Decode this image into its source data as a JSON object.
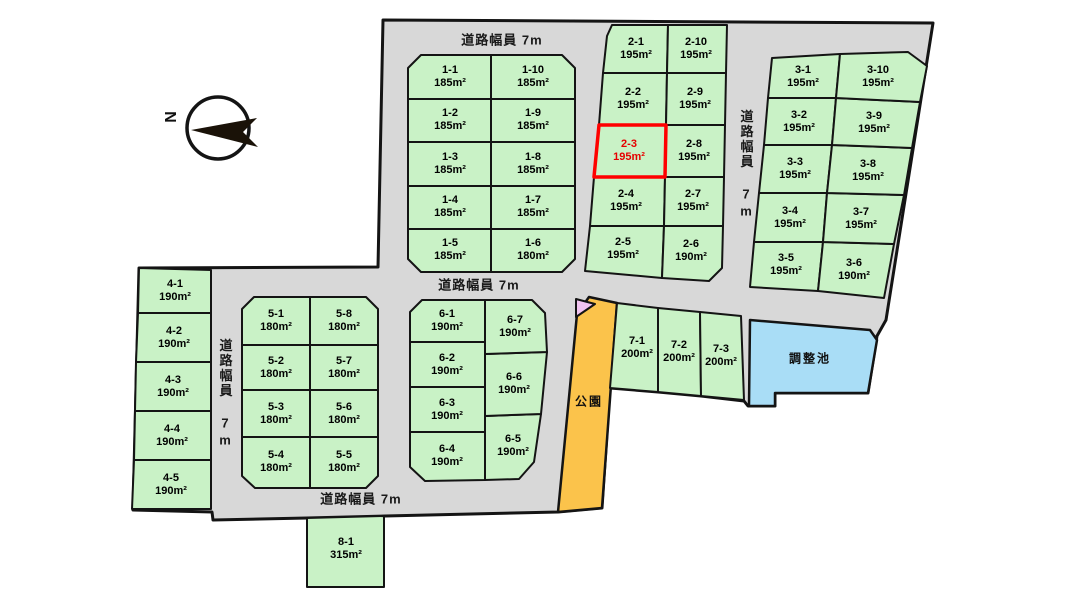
{
  "map_title": "宅地分譲区画図",
  "compass": {
    "north_label": "N"
  },
  "road_labels": {
    "top": "道路幅員 7m",
    "middle": "道路幅員 7m",
    "bottom": "道路幅員 7m",
    "left_vertical": "道路幅員 7m",
    "right_vertical": "道路幅員 7m"
  },
  "features": {
    "park_label": "公園",
    "pond_label": "調整池"
  },
  "highlighted_lot": "2-3",
  "colors": {
    "lot_fill": "#c9f2c6",
    "road_fill": "#d8d8d8",
    "park_fill": "#fbc34b",
    "pond_fill": "#a9ddf6",
    "pink_marker": "#f2c4f0",
    "outline": "#141414",
    "highlight_red": "#ff0000",
    "highlight_text": "#e60000"
  },
  "blocks": [
    {
      "name": "block-1",
      "lots": [
        {
          "id": "1-1",
          "area": "185m²"
        },
        {
          "id": "1-2",
          "area": "185m²"
        },
        {
          "id": "1-3",
          "area": "185m²"
        },
        {
          "id": "1-4",
          "area": "185m²"
        },
        {
          "id": "1-5",
          "area": "185m²"
        },
        {
          "id": "1-6",
          "area": "180m²"
        },
        {
          "id": "1-7",
          "area": "185m²"
        },
        {
          "id": "1-8",
          "area": "185m²"
        },
        {
          "id": "1-9",
          "area": "185m²"
        },
        {
          "id": "1-10",
          "area": "185m²"
        }
      ]
    },
    {
      "name": "block-2",
      "lots": [
        {
          "id": "2-1",
          "area": "195m²"
        },
        {
          "id": "2-2",
          "area": "195m²"
        },
        {
          "id": "2-3",
          "area": "195m²"
        },
        {
          "id": "2-4",
          "area": "195m²"
        },
        {
          "id": "2-5",
          "area": "195m²"
        },
        {
          "id": "2-6",
          "area": "190m²"
        },
        {
          "id": "2-7",
          "area": "195m²"
        },
        {
          "id": "2-8",
          "area": "195m²"
        },
        {
          "id": "2-9",
          "area": "195m²"
        },
        {
          "id": "2-10",
          "area": "195m²"
        }
      ]
    },
    {
      "name": "block-3",
      "lots": [
        {
          "id": "3-1",
          "area": "195m²"
        },
        {
          "id": "3-2",
          "area": "195m²"
        },
        {
          "id": "3-3",
          "area": "195m²"
        },
        {
          "id": "3-4",
          "area": "195m²"
        },
        {
          "id": "3-5",
          "area": "195m²"
        },
        {
          "id": "3-6",
          "area": "190m²"
        },
        {
          "id": "3-7",
          "area": "195m²"
        },
        {
          "id": "3-8",
          "area": "195m²"
        },
        {
          "id": "3-9",
          "area": "195m²"
        },
        {
          "id": "3-10",
          "area": "195m²"
        }
      ]
    },
    {
      "name": "block-4",
      "lots": [
        {
          "id": "4-1",
          "area": "190m²"
        },
        {
          "id": "4-2",
          "area": "190m²"
        },
        {
          "id": "4-3",
          "area": "190m²"
        },
        {
          "id": "4-4",
          "area": "190m²"
        },
        {
          "id": "4-5",
          "area": "190m²"
        }
      ]
    },
    {
      "name": "block-5",
      "lots": [
        {
          "id": "5-1",
          "area": "180m²"
        },
        {
          "id": "5-2",
          "area": "180m²"
        },
        {
          "id": "5-3",
          "area": "180m²"
        },
        {
          "id": "5-4",
          "area": "180m²"
        },
        {
          "id": "5-5",
          "area": "180m²"
        },
        {
          "id": "5-6",
          "area": "180m²"
        },
        {
          "id": "5-7",
          "area": "180m²"
        },
        {
          "id": "5-8",
          "area": "180m²"
        }
      ]
    },
    {
      "name": "block-6",
      "lots": [
        {
          "id": "6-1",
          "area": "190m²"
        },
        {
          "id": "6-2",
          "area": "190m²"
        },
        {
          "id": "6-3",
          "area": "190m²"
        },
        {
          "id": "6-4",
          "area": "190m²"
        },
        {
          "id": "6-5",
          "area": "190m²"
        },
        {
          "id": "6-6",
          "area": "190m²"
        },
        {
          "id": "6-7",
          "area": "190m²"
        }
      ]
    },
    {
      "name": "block-7",
      "lots": [
        {
          "id": "7-1",
          "area": "200m²"
        },
        {
          "id": "7-2",
          "area": "200m²"
        },
        {
          "id": "7-3",
          "area": "200m²"
        }
      ]
    },
    {
      "name": "block-8",
      "lots": [
        {
          "id": "8-1",
          "area": "315m²"
        }
      ]
    }
  ]
}
